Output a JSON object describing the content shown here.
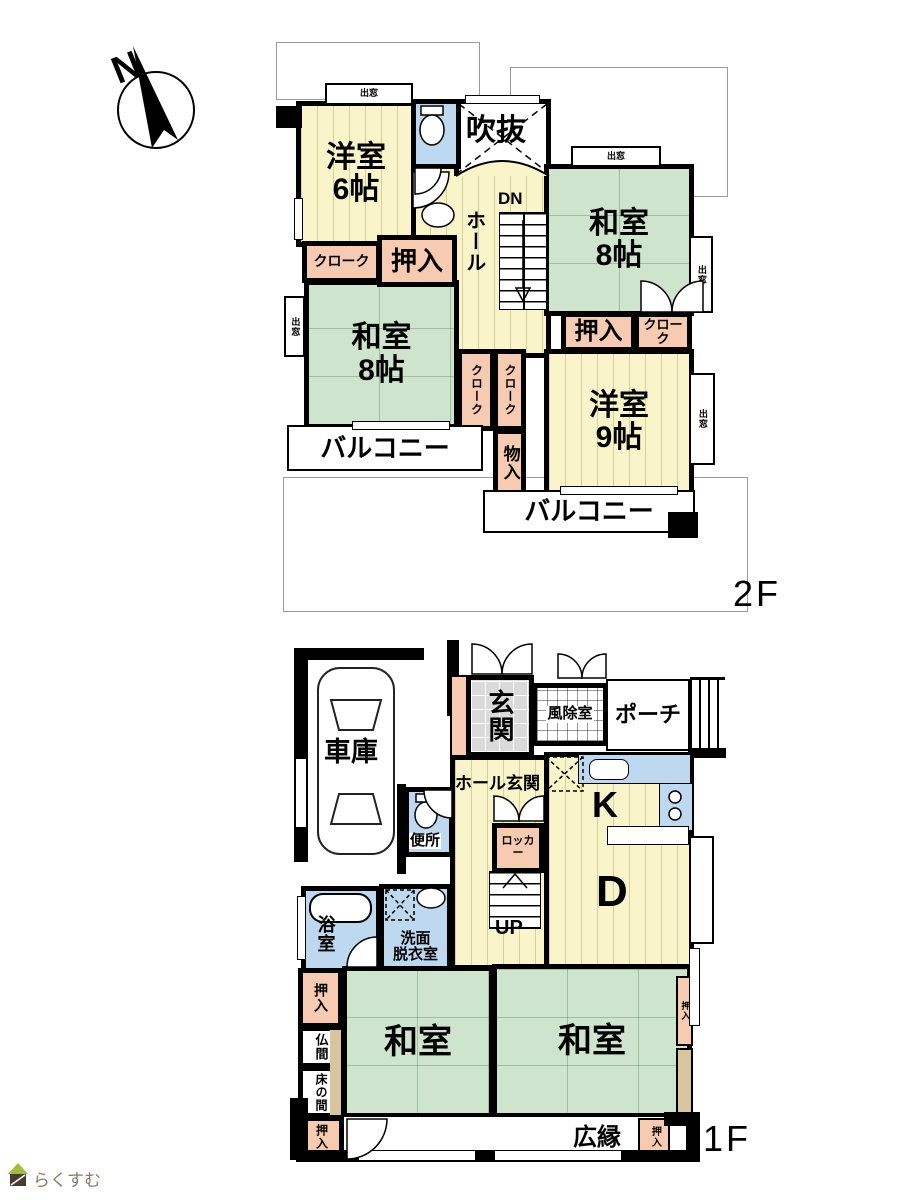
{
  "colors": {
    "wood": "#FAF4CA",
    "tatami": "#CFE4CD",
    "closet": "#F7CBB1",
    "wet": "#BDD8EF",
    "tile": "#DADADA",
    "tan": "#D8C49E",
    "wall": "#000000",
    "outline": "#9A9A9A",
    "logo_text": "#8A7A6A",
    "logo_roof": "#9FBE3C",
    "logo_body": "#4A3B30"
  },
  "compass": {
    "letter": "N"
  },
  "f2": {
    "floor_label": "2F",
    "rooms": {
      "yoshitsu6": {
        "name": "洋室",
        "size": "6帖"
      },
      "fukinuke": "吹抜",
      "hall": "ホール",
      "dn": "DN",
      "washitsu8_top": {
        "name": "和室",
        "size": "8帖"
      },
      "washitsu8_left": {
        "name": "和室",
        "size": "8帖"
      },
      "yoshitsu9": {
        "name": "洋室",
        "size": "9帖"
      },
      "oshiire_a": "押入",
      "cloak_a": "クローク",
      "oshiire_b": "押入",
      "cloak_b": "クローク",
      "cloak_v1": "クローク",
      "cloak_v2": "クローク",
      "monoiri": "物入",
      "balcony_left": "バルコニー",
      "balcony_bottom": "バルコニー",
      "demado": "出窓"
    }
  },
  "f1": {
    "floor_label": "1F",
    "rooms": {
      "garage": "車庫",
      "genkan": "玄関",
      "fujoshitsu": "風除室",
      "porch": "ポーチ",
      "hall_genkan": "ホール玄関",
      "benjo": "便所",
      "locker": "ロッカー",
      "kitchen": "K",
      "dining": "D",
      "up": "UP",
      "bath": "浴室",
      "senmen_line1": "洗面",
      "senmen_line2": "脱衣室",
      "oshiire_left": "押入",
      "butsuma": "仏間",
      "tokonoma": "床の間",
      "washitsu_left": "和室",
      "washitsu_right": "和室",
      "oshiire_right": "押入",
      "oshiire_bottom_left": "押入",
      "oshiire_bottom_right": "押入",
      "hiroen": "広縁"
    }
  },
  "logo": {
    "brand": "らくすむ"
  }
}
